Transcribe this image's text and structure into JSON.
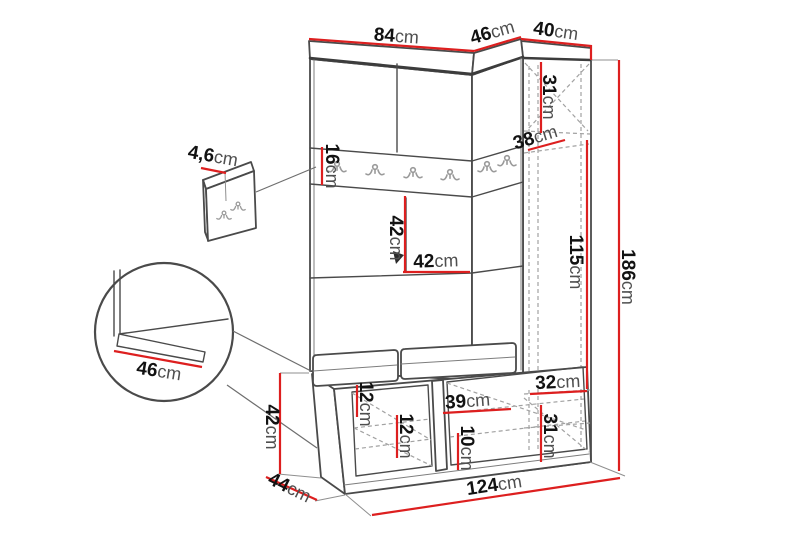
{
  "diagram": {
    "subject": "hallway wardrobe set dimension drawing",
    "components": [
      "main-cabinet",
      "coat-hook-rail",
      "corner-column",
      "shoe-bench-with-cushions",
      "wall-hook-panel",
      "seat-corner-detail-circle"
    ]
  },
  "colors": {
    "dimension_line": "#dd1f1f",
    "outline": "#4a4a4a",
    "hidden_edge": "#a2a2a2",
    "number_text": "#121212",
    "unit_text": "#4f4f4f",
    "background": "#ffffff"
  },
  "dimensions": {
    "width_main_top": {
      "value": "84",
      "unit": "cm"
    },
    "width_corner_top": {
      "value": "46",
      "unit": "cm"
    },
    "width_column_top": {
      "value": "40",
      "unit": "cm"
    },
    "column_top_section": {
      "value": "31",
      "unit": "cm"
    },
    "corner_top_depth": {
      "value": "38",
      "unit": "cm"
    },
    "column_middle_height": {
      "value": "115",
      "unit": "cm"
    },
    "overall_height": {
      "value": "186",
      "unit": "cm"
    },
    "wall_panel_depth": {
      "value": "4,6",
      "unit": "cm"
    },
    "hook_rail_height": {
      "value": "16",
      "unit": "cm"
    },
    "open_compartment_height": {
      "value": "42",
      "unit": "cm"
    },
    "open_compartment_width": {
      "value": "42",
      "unit": "cm"
    },
    "seat_corner_depth": {
      "value": "46",
      "unit": "cm"
    },
    "bench_height": {
      "value": "42",
      "unit": "cm"
    },
    "bench_depth": {
      "value": "44",
      "unit": "cm"
    },
    "bench_left_top_gap": {
      "value": "12",
      "unit": "cm"
    },
    "bench_left_shelf_gap": {
      "value": "12",
      "unit": "cm"
    },
    "bench_right_shelf_width": {
      "value": "39",
      "unit": "cm"
    },
    "bench_right_shelf_gap": {
      "value": "10",
      "unit": "cm"
    },
    "column_lower_section": {
      "value": "32",
      "unit": "cm"
    },
    "column_bottom_section": {
      "value": "31",
      "unit": "cm"
    },
    "overall_width": {
      "value": "124",
      "unit": "cm"
    }
  }
}
